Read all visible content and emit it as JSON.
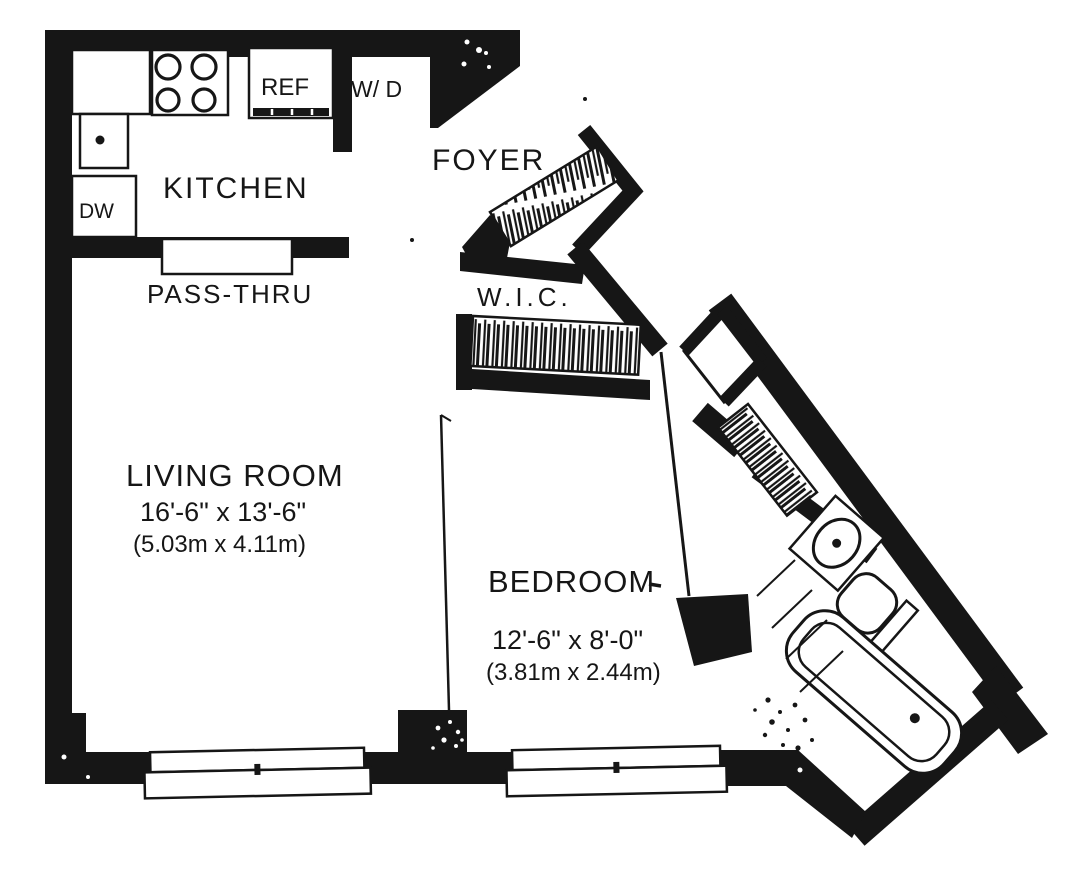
{
  "colors": {
    "ink": "#161616",
    "paper": "#ffffff"
  },
  "rooms": {
    "kitchen": {
      "label": "KITCHEN"
    },
    "foyer": {
      "label": "FOYER"
    },
    "walk_in_closet": {
      "label": "W.I.C."
    },
    "living_room": {
      "label": "LIVING ROOM",
      "dim_imperial": "16'-6\" x 13'-6\"",
      "dim_metric": "(5.03m x 4.11m)"
    },
    "bedroom": {
      "label": "BEDROOM",
      "dim_imperial": "12'-6\" x 8'-0\"",
      "dim_metric": "(3.81m x 2.44m)"
    }
  },
  "fixtures": {
    "pass_thru": {
      "label": "PASS-THRU"
    },
    "dishwasher": {
      "label": "DW"
    },
    "refrigerator": {
      "label": "REF"
    },
    "washer_dryer": {
      "label": "W/ D"
    }
  }
}
